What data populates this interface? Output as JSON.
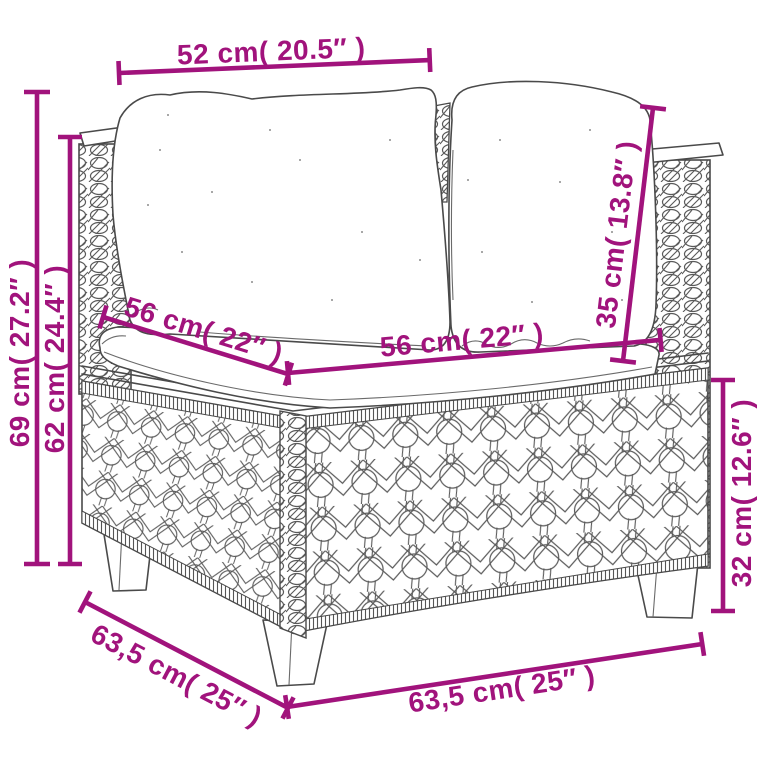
{
  "colors": {
    "dimension_accent": "#A1137C",
    "sketch_line": "#4a4a4a",
    "background": "#ffffff"
  },
  "dimensions": {
    "top_width": {
      "label": "52 cm( 20.5″ )"
    },
    "overall_height": {
      "label": "69 cm( 27.2″ )"
    },
    "side_height": {
      "label": "62 cm( 24.4″ )"
    },
    "seat_depth": {
      "label": "56 cm( 22″ )"
    },
    "seat_width": {
      "label": "56 cm( 22″ )"
    },
    "backrest_height": {
      "label": "35 cm( 13.8″ )"
    },
    "base_height": {
      "label": "32 cm( 12.6″ )"
    },
    "base_depth": {
      "label": "63,5 cm( 25″ )"
    },
    "base_width": {
      "label": "63,5 cm( 25″ )"
    }
  }
}
